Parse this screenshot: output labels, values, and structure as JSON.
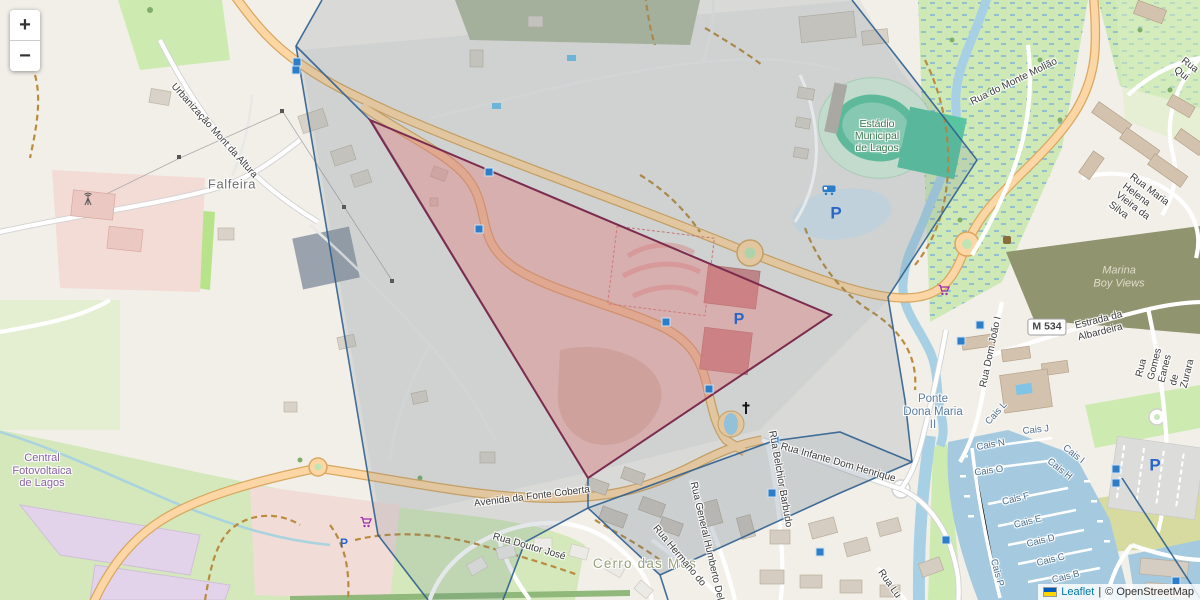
{
  "window": {
    "width": 1200,
    "height": 600,
    "app": "Leaflet map"
  },
  "controls": {
    "zoom_in": "+",
    "zoom_out": "−"
  },
  "attribution": {
    "flag": "ukraine-flag",
    "leaflet": "Leaflet",
    "separator": "|",
    "osm": "© OpenStreetMap"
  },
  "colors": {
    "map_background": "#f2efe9",
    "primary_road": "#fcd6a4",
    "water": "#a5cadf",
    "selection_fill": "#e07f7f",
    "selection_border": "#7c2d4f",
    "cell_line": "#2f5f8f",
    "cell_tint": "#5e7489"
  },
  "overlays": {
    "selection_triangle": {
      "fill": "#e07f7f",
      "fill_opacity": 0.42,
      "stroke": "#7c2d4f",
      "stroke_width": 2,
      "points": "370,120 831,315 588,478"
    },
    "cells": {
      "stroke": "#2f5f8f",
      "stroke_width": 1.6,
      "tint_fill": "#5e7489",
      "tint_opacity": 0.17,
      "tint_polygon": "322,0 852,0 907,70 977,160 888,297 905,400 912,462 840,493 660,575 588,508 525,542 503,600 428,600 378,535 296,46",
      "sliver_polygon": "588,508 773,441 840,432 912,462 840,493 660,575",
      "sliver_opacity": 0.1,
      "edges": [
        "322,0 296,46 378,535 428,600",
        "296,46 372,122 588,478 588,508",
        "588,508 525,542 503,600",
        "588,508 660,575 668,600",
        "660,575 840,493 912,462",
        "852,0 907,70 977,160 888,297 905,400 912,462",
        "588,508 773,441 840,432 912,462",
        "1122,478 1200,598"
      ]
    }
  },
  "labels": [
    {
      "id": "falfeira",
      "text": "Falfeira",
      "x": 232,
      "y": 185,
      "r": 0,
      "cls": "place"
    },
    {
      "id": "urbanizacao-mont-da-altura",
      "text": "Urbanização Mont da Altura",
      "x": 214,
      "y": 131,
      "r": 48,
      "cls": "street"
    },
    {
      "id": "estadio-municipal-de-lagos",
      "text": "Estádio\nMunicipal\nde Lagos",
      "x": 877,
      "y": 136,
      "r": 0,
      "cls": "poi-green"
    },
    {
      "id": "central-fotovoltaica-de-lagos",
      "text": "Central\nFotovoltaica\nde Lagos",
      "x": 42,
      "y": 471,
      "r": 0,
      "cls": "poi-purple"
    },
    {
      "id": "avenida-da-fonte-coberta",
      "text": "Avenida da Fonte Coberta",
      "x": 532,
      "y": 497,
      "r": -7,
      "cls": "street"
    },
    {
      "id": "cerro-das-mos",
      "text": "Cerro das Mós",
      "x": 645,
      "y": 564,
      "r": 0,
      "cls": "hamlet"
    },
    {
      "id": "ponte-dona-maria-ii",
      "text": "Ponte\nDona Maria\nII",
      "x": 933,
      "y": 413,
      "r": 0,
      "cls": "bridge"
    },
    {
      "id": "marina-boy-views",
      "text": "Marina\nBoy Views",
      "x": 1119,
      "y": 277,
      "r": 0,
      "cls": "hill"
    },
    {
      "id": "road-ref-m534",
      "text": "M 534",
      "x": 1047,
      "y": 327,
      "r": 0,
      "cls": "shield"
    },
    {
      "id": "estrada-da-albardeira",
      "text": "Estrada da Albardeira",
      "x": 1117,
      "y": 322,
      "r": -14,
      "cls": "street"
    },
    {
      "id": "rua-dom-joao-i",
      "text": "Rua Dom João I",
      "x": 991,
      "y": 352,
      "r": -78,
      "cls": "street"
    },
    {
      "id": "rua-do-monte-moliao",
      "text": "Rua do Monte Molião",
      "x": 1014,
      "y": 82,
      "r": -26,
      "cls": "street"
    },
    {
      "id": "rua-maria-helena-vieira-da-silva",
      "text": "Rua Maria Helena Vieira da Silva",
      "x": 1143,
      "y": 207,
      "r": 37,
      "cls": "street"
    },
    {
      "id": "rua-gomes-eanes-de-zurara",
      "text": "Rua Gomes Eanes de Zurara",
      "x": 1166,
      "y": 366,
      "r": -76,
      "cls": "street"
    },
    {
      "id": "rua-infante-dom-henrique",
      "text": "Rua Infante Dom Henrique",
      "x": 838,
      "y": 463,
      "r": 16,
      "cls": "street"
    },
    {
      "id": "rua-belchior-barbudo",
      "text": "Rua Belchior Barbudo",
      "x": 780,
      "y": 479,
      "r": 80,
      "cls": "street"
    },
    {
      "id": "rua-general-humberto-delgado",
      "text": "Rua General Humberto Delgado",
      "x": 709,
      "y": 552,
      "r": 77,
      "cls": "street"
    },
    {
      "id": "rua-hermano-do",
      "text": "Rua Hermano do",
      "x": 679,
      "y": 556,
      "r": 50,
      "cls": "street"
    },
    {
      "id": "rua-doutor-jose",
      "text": "Rua Doutor José",
      "x": 529,
      "y": 547,
      "r": 16,
      "cls": "street"
    },
    {
      "id": "rua-lu",
      "text": "Rua Lu",
      "x": 889,
      "y": 584,
      "r": 55,
      "cls": "street"
    },
    {
      "id": "rua-qui",
      "text": "Rua Qui",
      "x": 1186,
      "y": 70,
      "r": 38,
      "cls": "street"
    },
    {
      "id": "cais-l",
      "text": "Cais L",
      "x": 997,
      "y": 414,
      "r": -48,
      "cls": "water"
    },
    {
      "id": "cais-j",
      "text": "Cais J",
      "x": 1036,
      "y": 431,
      "r": -6,
      "cls": "water"
    },
    {
      "id": "cais-n",
      "text": "Cais N",
      "x": 991,
      "y": 446,
      "r": -10,
      "cls": "water"
    },
    {
      "id": "cais-i",
      "text": "Cais I",
      "x": 1073,
      "y": 455,
      "r": 38,
      "cls": "water"
    },
    {
      "id": "cais-h",
      "text": "Cais H",
      "x": 1059,
      "y": 470,
      "r": 38,
      "cls": "water"
    },
    {
      "id": "cais-o",
      "text": "Cais O",
      "x": 989,
      "y": 472,
      "r": -8,
      "cls": "water"
    },
    {
      "id": "cais-f",
      "text": "Cais F",
      "x": 1016,
      "y": 500,
      "r": -14,
      "cls": "water"
    },
    {
      "id": "cais-e",
      "text": "Cais E",
      "x": 1028,
      "y": 523,
      "r": -14,
      "cls": "water"
    },
    {
      "id": "cais-d",
      "text": "Cais D",
      "x": 1041,
      "y": 542,
      "r": -14,
      "cls": "water"
    },
    {
      "id": "cais-c",
      "text": "Cais C",
      "x": 1051,
      "y": 561,
      "r": -14,
      "cls": "water"
    },
    {
      "id": "cais-b",
      "text": "Cais B",
      "x": 1066,
      "y": 578,
      "r": -14,
      "cls": "water"
    },
    {
      "id": "cais-p",
      "text": "Cais P",
      "x": 996,
      "y": 573,
      "r": 75,
      "cls": "water"
    }
  ],
  "markers": [
    {
      "type": "signal",
      "x": 297,
      "y": 62
    },
    {
      "type": "signal",
      "x": 296,
      "y": 70
    },
    {
      "type": "signal",
      "x": 489,
      "y": 172
    },
    {
      "type": "signal",
      "x": 479,
      "y": 229
    },
    {
      "type": "signal",
      "x": 666,
      "y": 322
    },
    {
      "type": "signal",
      "x": 709,
      "y": 389
    },
    {
      "type": "signal",
      "x": 775,
      "y": 440
    },
    {
      "type": "signal",
      "x": 772,
      "y": 493
    },
    {
      "type": "signal",
      "x": 820,
      "y": 552
    },
    {
      "type": "signal",
      "x": 980,
      "y": 325
    },
    {
      "type": "signal",
      "x": 961,
      "y": 341
    },
    {
      "type": "signal",
      "x": 1116,
      "y": 469
    },
    {
      "type": "signal",
      "x": 1116,
      "y": 483
    },
    {
      "type": "signal",
      "x": 946,
      "y": 540
    },
    {
      "type": "signal",
      "x": 1176,
      "y": 581
    },
    {
      "type": "parking",
      "x": 739,
      "y": 320,
      "s": 16
    },
    {
      "type": "parking",
      "x": 836,
      "y": 213,
      "s": 17
    },
    {
      "type": "parking",
      "x": 1155,
      "y": 465,
      "s": 17
    },
    {
      "type": "parking",
      "x": 344,
      "y": 543,
      "s": 12
    },
    {
      "type": "cart",
      "x": 366,
      "y": 522
    },
    {
      "type": "cart",
      "x": 944,
      "y": 290
    },
    {
      "type": "camper",
      "x": 829,
      "y": 190
    },
    {
      "type": "church",
      "x": 746,
      "y": 408
    },
    {
      "type": "mast",
      "x": 88,
      "y": 199
    },
    {
      "type": "poi",
      "x": 1007,
      "y": 240
    }
  ]
}
